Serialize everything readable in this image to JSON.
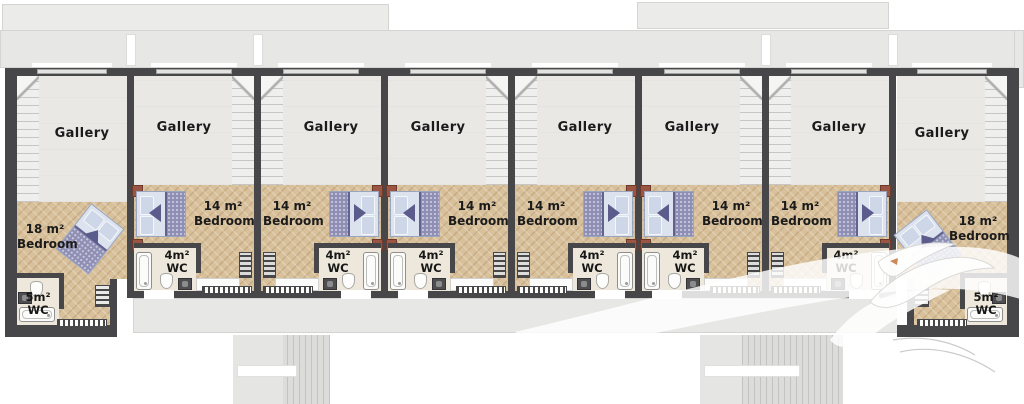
{
  "units": [
    {
      "id": "unit-1",
      "type": "end-left",
      "gallery_label": "Gallery",
      "bedroom_size": "18 m²",
      "bedroom_name": "Bedroom",
      "wc_size": "5m²",
      "wc_name": "WC"
    },
    {
      "id": "unit-2",
      "type": "middle",
      "gallery_label": "Gallery",
      "bedroom_size": "14 m²",
      "bedroom_name": "Bedroom",
      "wc_size": "4m²",
      "wc_name": "WC"
    },
    {
      "id": "unit-3",
      "type": "middle",
      "gallery_label": "Gallery",
      "bedroom_size": "14 m²",
      "bedroom_name": "Bedroom",
      "wc_size": "4m²",
      "wc_name": "WC"
    },
    {
      "id": "unit-4",
      "type": "middle",
      "gallery_label": "Gallery",
      "bedroom_size": "14 m²",
      "bedroom_name": "Bedroom",
      "wc_size": "4m²",
      "wc_name": "WC"
    },
    {
      "id": "unit-5",
      "type": "middle",
      "gallery_label": "Gallery",
      "bedroom_size": "14 m²",
      "bedroom_name": "Bedroom",
      "wc_size": "4m²",
      "wc_name": "WC"
    },
    {
      "id": "unit-6",
      "type": "middle",
      "gallery_label": "Gallery",
      "bedroom_size": "14 m²",
      "bedroom_name": "Bedroom",
      "wc_size": "4m²",
      "wc_name": "WC"
    },
    {
      "id": "unit-7",
      "type": "middle",
      "gallery_label": "Gallery",
      "bedroom_size": "14 m²",
      "bedroom_name": "Bedroom",
      "wc_size": "4m²",
      "wc_name": "WC"
    },
    {
      "id": "unit-8",
      "type": "end-right",
      "gallery_label": "Gallery",
      "bedroom_size": "18 m²",
      "bedroom_name": "Bedroom",
      "wc_size": "5m²",
      "wc_name": "WC"
    }
  ],
  "colors": {
    "wall": "#47474a",
    "wood_floor": "#d8c09b",
    "gallery_floor": "#e9e8e5",
    "wc_floor": "#ede8db",
    "roof_terrace": "#e7e7e5",
    "bed_blanket": "#8f8fb5",
    "bed_mattress": "#dde3ee",
    "nightstand": "#9a5543"
  }
}
